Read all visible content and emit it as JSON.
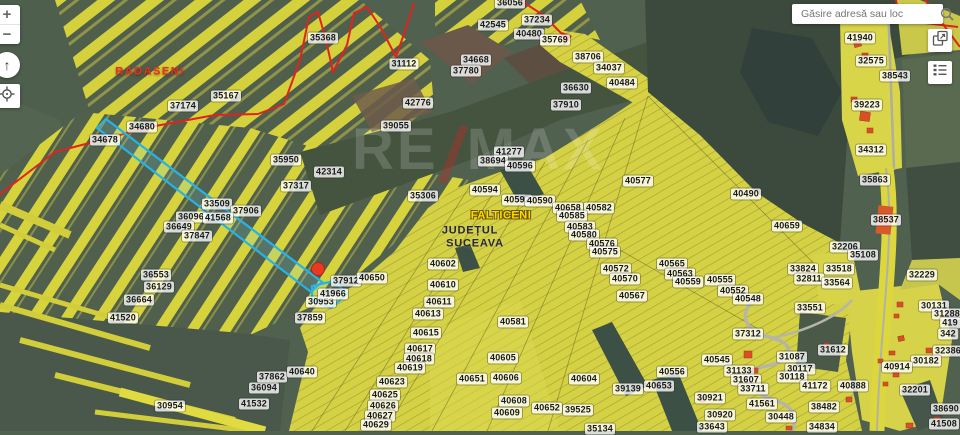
{
  "search": {
    "placeholder": "Găsire adresă sau loc"
  },
  "controls": {
    "zoom_in": "+",
    "zoom_out": "−",
    "compass": "↑"
  },
  "watermark": {
    "part1": "RE",
    "slash": "/",
    "part2": "MAX"
  },
  "theme": {
    "field_yellow": "#d4d145",
    "strip_yellow": "#d5d13c",
    "base_green": "#51614f",
    "forest_green": "#3c4a3e",
    "boundary_red": "#e0231c",
    "highlight_cyan": "#25b3e8",
    "pin_red": "#e63a22",
    "house_orange": "#d94f27",
    "road_gray": "#b5b5a8",
    "label_city_red": "#e8311a",
    "label_town_yellow": "#ffd800"
  },
  "map": {
    "labels": [
      {
        "t": "RADASENI",
        "x": 150,
        "y": 72,
        "c": "city"
      },
      {
        "t": "FALTICENI",
        "x": 501,
        "y": 216,
        "c": "town"
      },
      {
        "t": "JUDEȚUL",
        "x": 470,
        "y": 231,
        "c": "county"
      },
      {
        "t": "SUCEAVA",
        "x": 475,
        "y": 244,
        "c": "county"
      },
      {
        "t": "35368",
        "x": 323,
        "y": 38
      },
      {
        "t": "35167",
        "x": 226,
        "y": 96
      },
      {
        "t": "37174",
        "x": 183,
        "y": 106
      },
      {
        "t": "34680",
        "x": 142,
        "y": 127
      },
      {
        "t": "34678",
        "x": 105,
        "y": 140
      },
      {
        "t": "35950",
        "x": 286,
        "y": 160
      },
      {
        "t": "42314",
        "x": 329,
        "y": 172
      },
      {
        "t": "37317",
        "x": 296,
        "y": 186
      },
      {
        "t": "31112",
        "x": 404,
        "y": 64
      },
      {
        "t": "34668",
        "x": 476,
        "y": 60
      },
      {
        "t": "37780",
        "x": 466,
        "y": 71
      },
      {
        "t": "42776",
        "x": 418,
        "y": 103
      },
      {
        "t": "39055",
        "x": 396,
        "y": 126
      },
      {
        "t": "33509",
        "x": 217,
        "y": 204
      },
      {
        "t": "37906",
        "x": 246,
        "y": 211
      },
      {
        "t": "36096",
        "x": 191,
        "y": 217
      },
      {
        "t": "41568",
        "x": 218,
        "y": 218
      },
      {
        "t": "36649",
        "x": 179,
        "y": 227
      },
      {
        "t": "37847",
        "x": 197,
        "y": 236
      },
      {
        "t": "36553",
        "x": 156,
        "y": 275
      },
      {
        "t": "36129",
        "x": 159,
        "y": 287
      },
      {
        "t": "36664",
        "x": 139,
        "y": 300
      },
      {
        "t": "41520",
        "x": 123,
        "y": 318
      },
      {
        "t": "30954",
        "x": 170,
        "y": 406
      },
      {
        "t": "41532",
        "x": 254,
        "y": 404
      },
      {
        "t": "36094",
        "x": 264,
        "y": 388
      },
      {
        "t": "37862",
        "x": 272,
        "y": 377
      },
      {
        "t": "40640",
        "x": 302,
        "y": 372
      },
      {
        "t": "37859",
        "x": 310,
        "y": 318
      },
      {
        "t": "30953",
        "x": 321,
        "y": 302
      },
      {
        "t": "41966",
        "x": 333,
        "y": 294
      },
      {
        "t": "37912",
        "x": 346,
        "y": 281
      },
      {
        "t": "40650",
        "x": 372,
        "y": 278
      },
      {
        "t": "36056",
        "x": 510,
        "y": 3
      },
      {
        "t": "42545",
        "x": 493,
        "y": 25
      },
      {
        "t": "37234",
        "x": 537,
        "y": 20
      },
      {
        "t": "40480",
        "x": 529,
        "y": 34
      },
      {
        "t": "35769",
        "x": 555,
        "y": 40
      },
      {
        "t": "38706",
        "x": 588,
        "y": 57
      },
      {
        "t": "34037",
        "x": 609,
        "y": 68
      },
      {
        "t": "40484",
        "x": 622,
        "y": 83
      },
      {
        "t": "36630",
        "x": 576,
        "y": 88
      },
      {
        "t": "37910",
        "x": 566,
        "y": 105
      },
      {
        "t": "41277",
        "x": 509,
        "y": 152
      },
      {
        "t": "38694",
        "x": 493,
        "y": 161
      },
      {
        "t": "40596",
        "x": 520,
        "y": 166
      },
      {
        "t": "40594",
        "x": 485,
        "y": 190
      },
      {
        "t": "35306",
        "x": 423,
        "y": 196
      },
      {
        "t": "40592",
        "x": 517,
        "y": 200
      },
      {
        "t": "40590",
        "x": 540,
        "y": 201
      },
      {
        "t": "40658",
        "x": 568,
        "y": 208
      },
      {
        "t": "40582",
        "x": 599,
        "y": 208
      },
      {
        "t": "40585",
        "x": 572,
        "y": 216
      },
      {
        "t": "40577",
        "x": 638,
        "y": 181
      },
      {
        "t": "40583",
        "x": 580,
        "y": 227
      },
      {
        "t": "40580",
        "x": 584,
        "y": 235
      },
      {
        "t": "40576",
        "x": 602,
        "y": 244
      },
      {
        "t": "40575",
        "x": 605,
        "y": 252
      },
      {
        "t": "40572",
        "x": 616,
        "y": 269
      },
      {
        "t": "40570",
        "x": 625,
        "y": 279
      },
      {
        "t": "40567",
        "x": 632,
        "y": 296
      },
      {
        "t": "40565",
        "x": 672,
        "y": 264
      },
      {
        "t": "40563",
        "x": 680,
        "y": 274
      },
      {
        "t": "40559",
        "x": 688,
        "y": 282
      },
      {
        "t": "40555",
        "x": 720,
        "y": 280
      },
      {
        "t": "40552",
        "x": 733,
        "y": 291
      },
      {
        "t": "40548",
        "x": 748,
        "y": 299
      },
      {
        "t": "40490",
        "x": 746,
        "y": 194
      },
      {
        "t": "40659",
        "x": 787,
        "y": 226
      },
      {
        "t": "40602",
        "x": 443,
        "y": 264
      },
      {
        "t": "40610",
        "x": 443,
        "y": 285
      },
      {
        "t": "40611",
        "x": 439,
        "y": 302
      },
      {
        "t": "40613",
        "x": 428,
        "y": 314
      },
      {
        "t": "40615",
        "x": 426,
        "y": 333
      },
      {
        "t": "40617",
        "x": 420,
        "y": 349
      },
      {
        "t": "40618",
        "x": 419,
        "y": 359
      },
      {
        "t": "40619",
        "x": 410,
        "y": 368
      },
      {
        "t": "40623",
        "x": 392,
        "y": 382
      },
      {
        "t": "40625",
        "x": 385,
        "y": 395
      },
      {
        "t": "40626",
        "x": 383,
        "y": 406
      },
      {
        "t": "40627",
        "x": 380,
        "y": 416
      },
      {
        "t": "40629",
        "x": 376,
        "y": 425
      },
      {
        "t": "40581",
        "x": 513,
        "y": 322
      },
      {
        "t": "40605",
        "x": 503,
        "y": 358
      },
      {
        "t": "40606",
        "x": 506,
        "y": 378
      },
      {
        "t": "40651",
        "x": 472,
        "y": 379
      },
      {
        "t": "40608",
        "x": 514,
        "y": 401
      },
      {
        "t": "40609",
        "x": 507,
        "y": 413
      },
      {
        "t": "40652",
        "x": 547,
        "y": 408
      },
      {
        "t": "39525",
        "x": 578,
        "y": 410
      },
      {
        "t": "35134",
        "x": 600,
        "y": 429
      },
      {
        "t": "40604",
        "x": 584,
        "y": 379
      },
      {
        "t": "39139",
        "x": 628,
        "y": 389
      },
      {
        "t": "40653",
        "x": 659,
        "y": 386
      },
      {
        "t": "40556",
        "x": 672,
        "y": 372
      },
      {
        "t": "33551",
        "x": 810,
        "y": 308
      },
      {
        "t": "37312",
        "x": 748,
        "y": 334
      },
      {
        "t": "40545",
        "x": 717,
        "y": 360
      },
      {
        "t": "31133",
        "x": 739,
        "y": 371
      },
      {
        "t": "31607",
        "x": 746,
        "y": 380
      },
      {
        "t": "33711",
        "x": 753,
        "y": 389
      },
      {
        "t": "41561",
        "x": 762,
        "y": 404
      },
      {
        "t": "30448",
        "x": 781,
        "y": 417
      },
      {
        "t": "31087",
        "x": 792,
        "y": 357
      },
      {
        "t": "30117",
        "x": 800,
        "y": 369
      },
      {
        "t": "30118",
        "x": 792,
        "y": 377
      },
      {
        "t": "41172",
        "x": 815,
        "y": 386
      },
      {
        "t": "30921",
        "x": 710,
        "y": 398
      },
      {
        "t": "30920",
        "x": 720,
        "y": 415
      },
      {
        "t": "33643",
        "x": 712,
        "y": 427
      },
      {
        "t": "38482",
        "x": 824,
        "y": 407
      },
      {
        "t": "34834",
        "x": 822,
        "y": 427
      },
      {
        "t": "41940",
        "x": 860,
        "y": 38
      },
      {
        "t": "32575",
        "x": 871,
        "y": 61
      },
      {
        "t": "38543",
        "x": 895,
        "y": 76
      },
      {
        "t": "39223",
        "x": 867,
        "y": 105
      },
      {
        "t": "34312",
        "x": 871,
        "y": 150
      },
      {
        "t": "35863",
        "x": 875,
        "y": 180
      },
      {
        "t": "38537",
        "x": 886,
        "y": 220
      },
      {
        "t": "32206",
        "x": 845,
        "y": 247
      },
      {
        "t": "35108",
        "x": 863,
        "y": 255
      },
      {
        "t": "33824",
        "x": 803,
        "y": 269
      },
      {
        "t": "32811",
        "x": 809,
        "y": 279
      },
      {
        "t": "33518",
        "x": 839,
        "y": 269
      },
      {
        "t": "33564",
        "x": 837,
        "y": 283
      },
      {
        "t": "32229",
        "x": 922,
        "y": 275
      },
      {
        "t": "30131",
        "x": 934,
        "y": 306
      },
      {
        "t": "31288",
        "x": 947,
        "y": 314
      },
      {
        "t": "419",
        "x": 950,
        "y": 323
      },
      {
        "t": "342",
        "x": 948,
        "y": 334
      },
      {
        "t": "32386",
        "x": 948,
        "y": 351
      },
      {
        "t": "31612",
        "x": 833,
        "y": 350
      },
      {
        "t": "30182",
        "x": 926,
        "y": 361
      },
      {
        "t": "40914",
        "x": 897,
        "y": 367
      },
      {
        "t": "40888",
        "x": 853,
        "y": 386
      },
      {
        "t": "32201",
        "x": 915,
        "y": 390
      },
      {
        "t": "38690",
        "x": 946,
        "y": 409
      },
      {
        "t": "41508",
        "x": 944,
        "y": 424
      }
    ]
  }
}
